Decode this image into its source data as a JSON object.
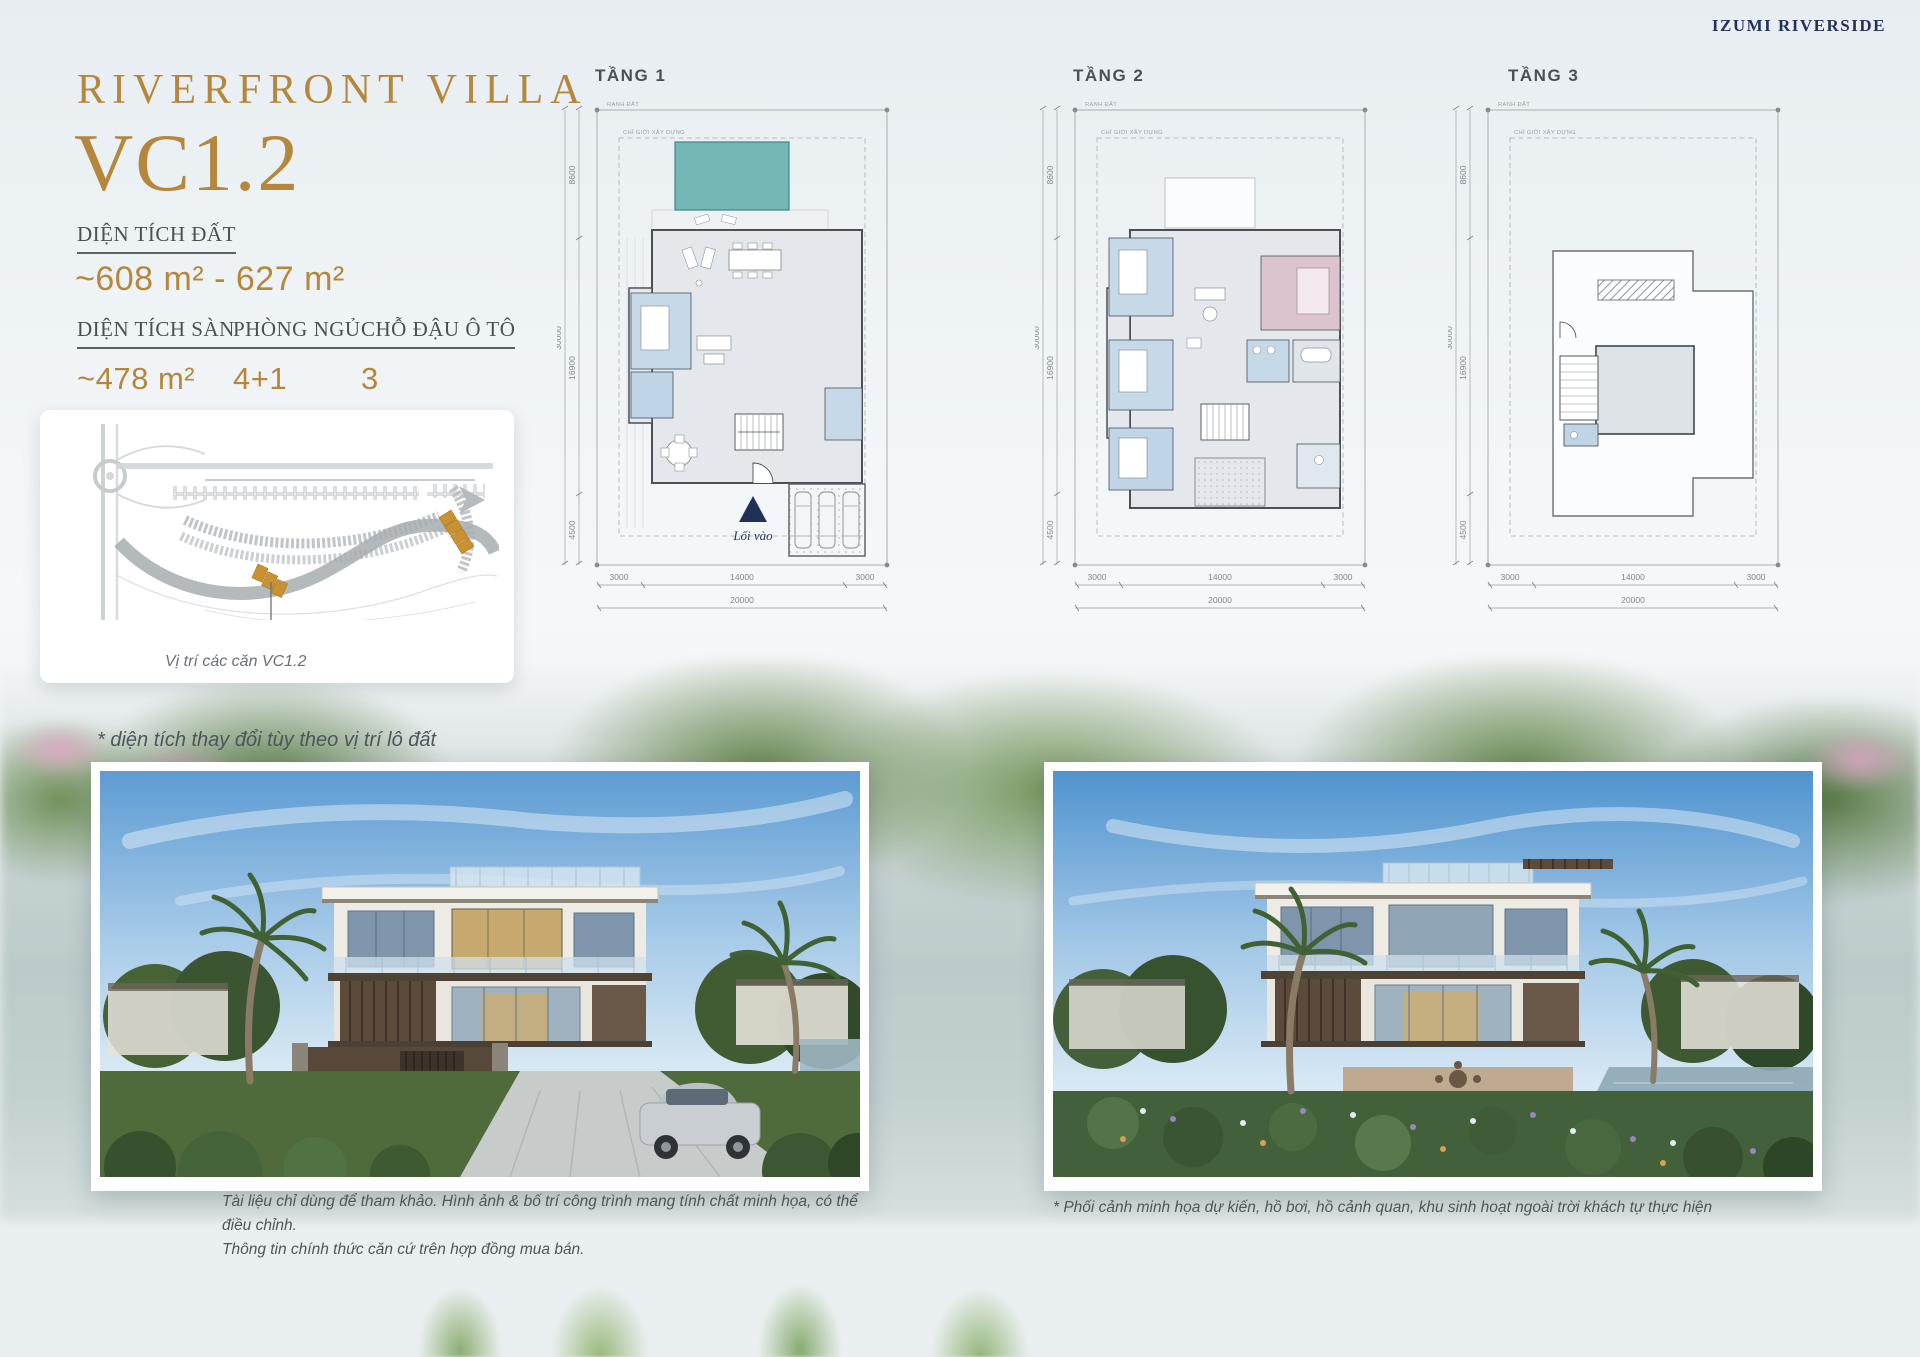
{
  "page": {
    "brand": "IZUMI RIVERSIDE",
    "title_line1": "RIVERFRONT VILLA",
    "title_line2": "VC1.2",
    "note": "* diện tích thay đổi tùy theo vị trí lô đất",
    "colors": {
      "gold": "#b5873c",
      "navy": "#1f3157",
      "pool_teal": "#74b7b4",
      "lot_orange": "#c9912f"
    }
  },
  "specs": {
    "land": {
      "label": "DIỆN TÍCH ĐẤT",
      "value": "~608 m² - 627 m²"
    },
    "floor": {
      "label": "DIỆN TÍCH SÀN",
      "value": "~478 m²"
    },
    "bedrooms": {
      "label": "PHÒNG NGỦ",
      "value": "4+1"
    },
    "parking": {
      "label": "CHỖ ĐẬU Ô TÔ",
      "value": "3"
    }
  },
  "site_map": {
    "caption": "Vị trí các căn VC1.2"
  },
  "plans": {
    "boundary_label": "RANH ĐẤT",
    "setback_label": "CHỈ GIỚI XÂY DỰNG",
    "entry_label": "Lối vào",
    "dims": {
      "left": [
        "8600",
        "16900",
        "4500"
      ],
      "left_total": "30000",
      "bottom": [
        "3000",
        "14000",
        "3000"
      ],
      "bottom_total": "20000"
    },
    "items": [
      {
        "label": "TẦNG 1"
      },
      {
        "label": "TẦNG 2"
      },
      {
        "label": "TẦNG 3"
      }
    ]
  },
  "photos": {
    "left_caption_line1": "Tài liệu chỉ dùng để tham khảo. Hình ảnh & bố trí công trình mang tính chất minh họa, có thể điều chỉnh.",
    "left_caption_line2": "Thông tin chính thức căn cứ trên hợp đồng mua bán.",
    "right_caption": "* Phối cảnh minh họa dự kiến, hồ bơi, hồ cảnh quan, khu sinh hoạt ngoài trời khách tự thực hiện"
  }
}
